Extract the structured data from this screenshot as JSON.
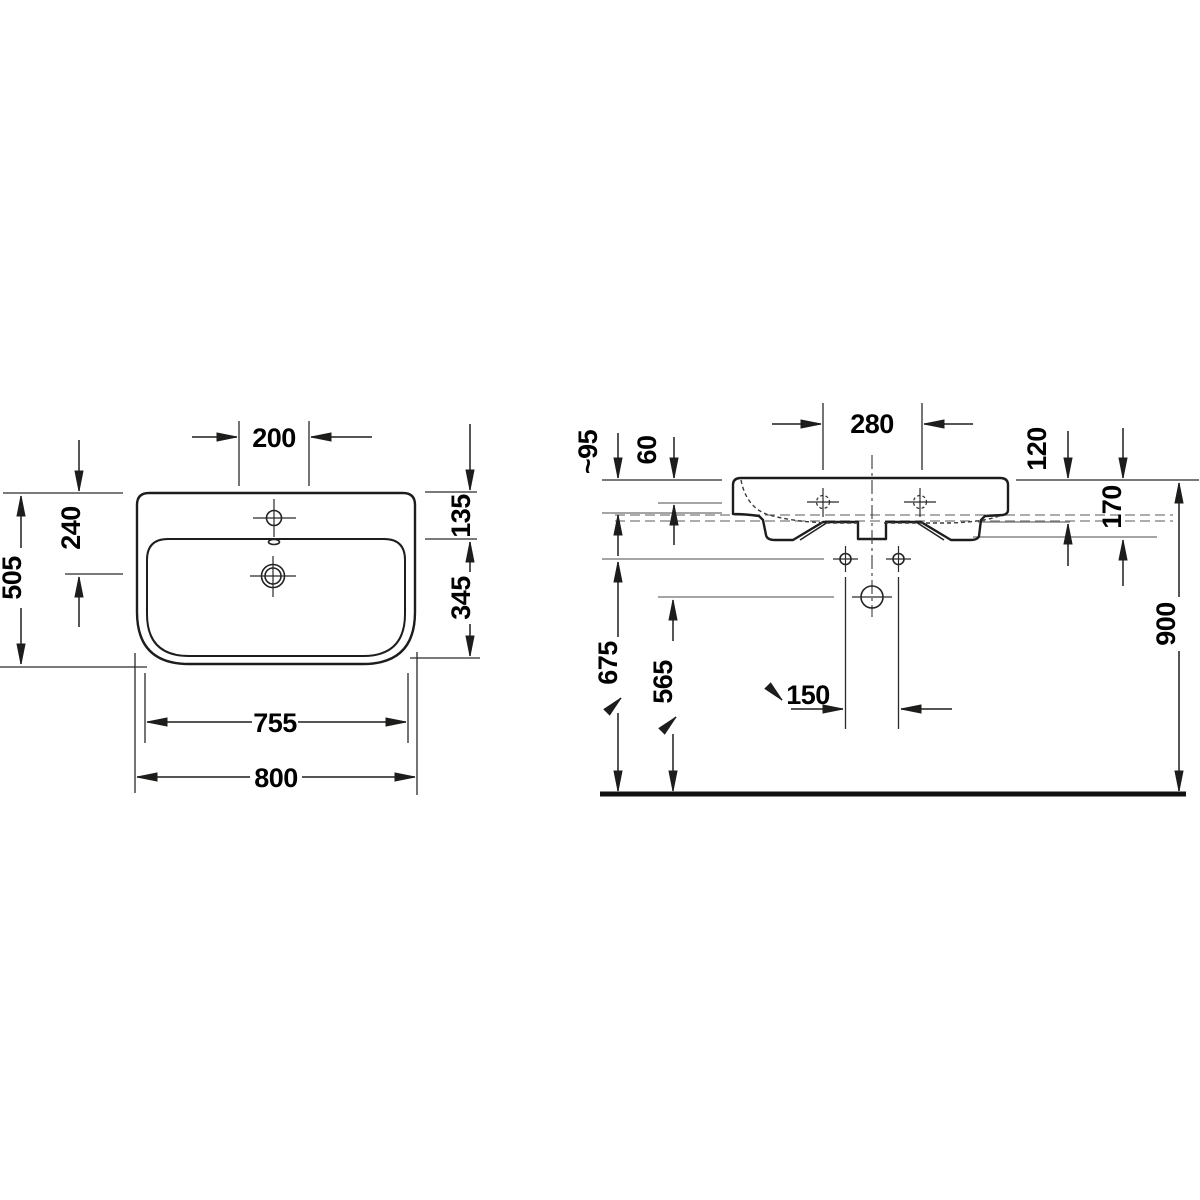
{
  "drawing": {
    "kind": "washbasin technical dimension drawing, two views (plan view and side section), all values in mm",
    "colors": {
      "line": "#1d1d1b",
      "light_line": "#6f6f6f",
      "background": "#ffffff",
      "text": "#000000"
    },
    "top_view": {
      "hole_spacing": "200",
      "overall_depth": "505",
      "rim_to_drain": "240",
      "rim_to_bowl": "135",
      "bowl_depth": "345",
      "bowl_width": "755",
      "overall_width": "800"
    },
    "side_view": {
      "hole_spacing": "280",
      "overflow_depth": "~95",
      "rim_to_overflow": "60",
      "rim_to_underside": "120",
      "apron_height": "170",
      "fixing_height": "675",
      "outlet_height": "565",
      "fixing_spacing": "150",
      "installation_height": "900"
    }
  }
}
